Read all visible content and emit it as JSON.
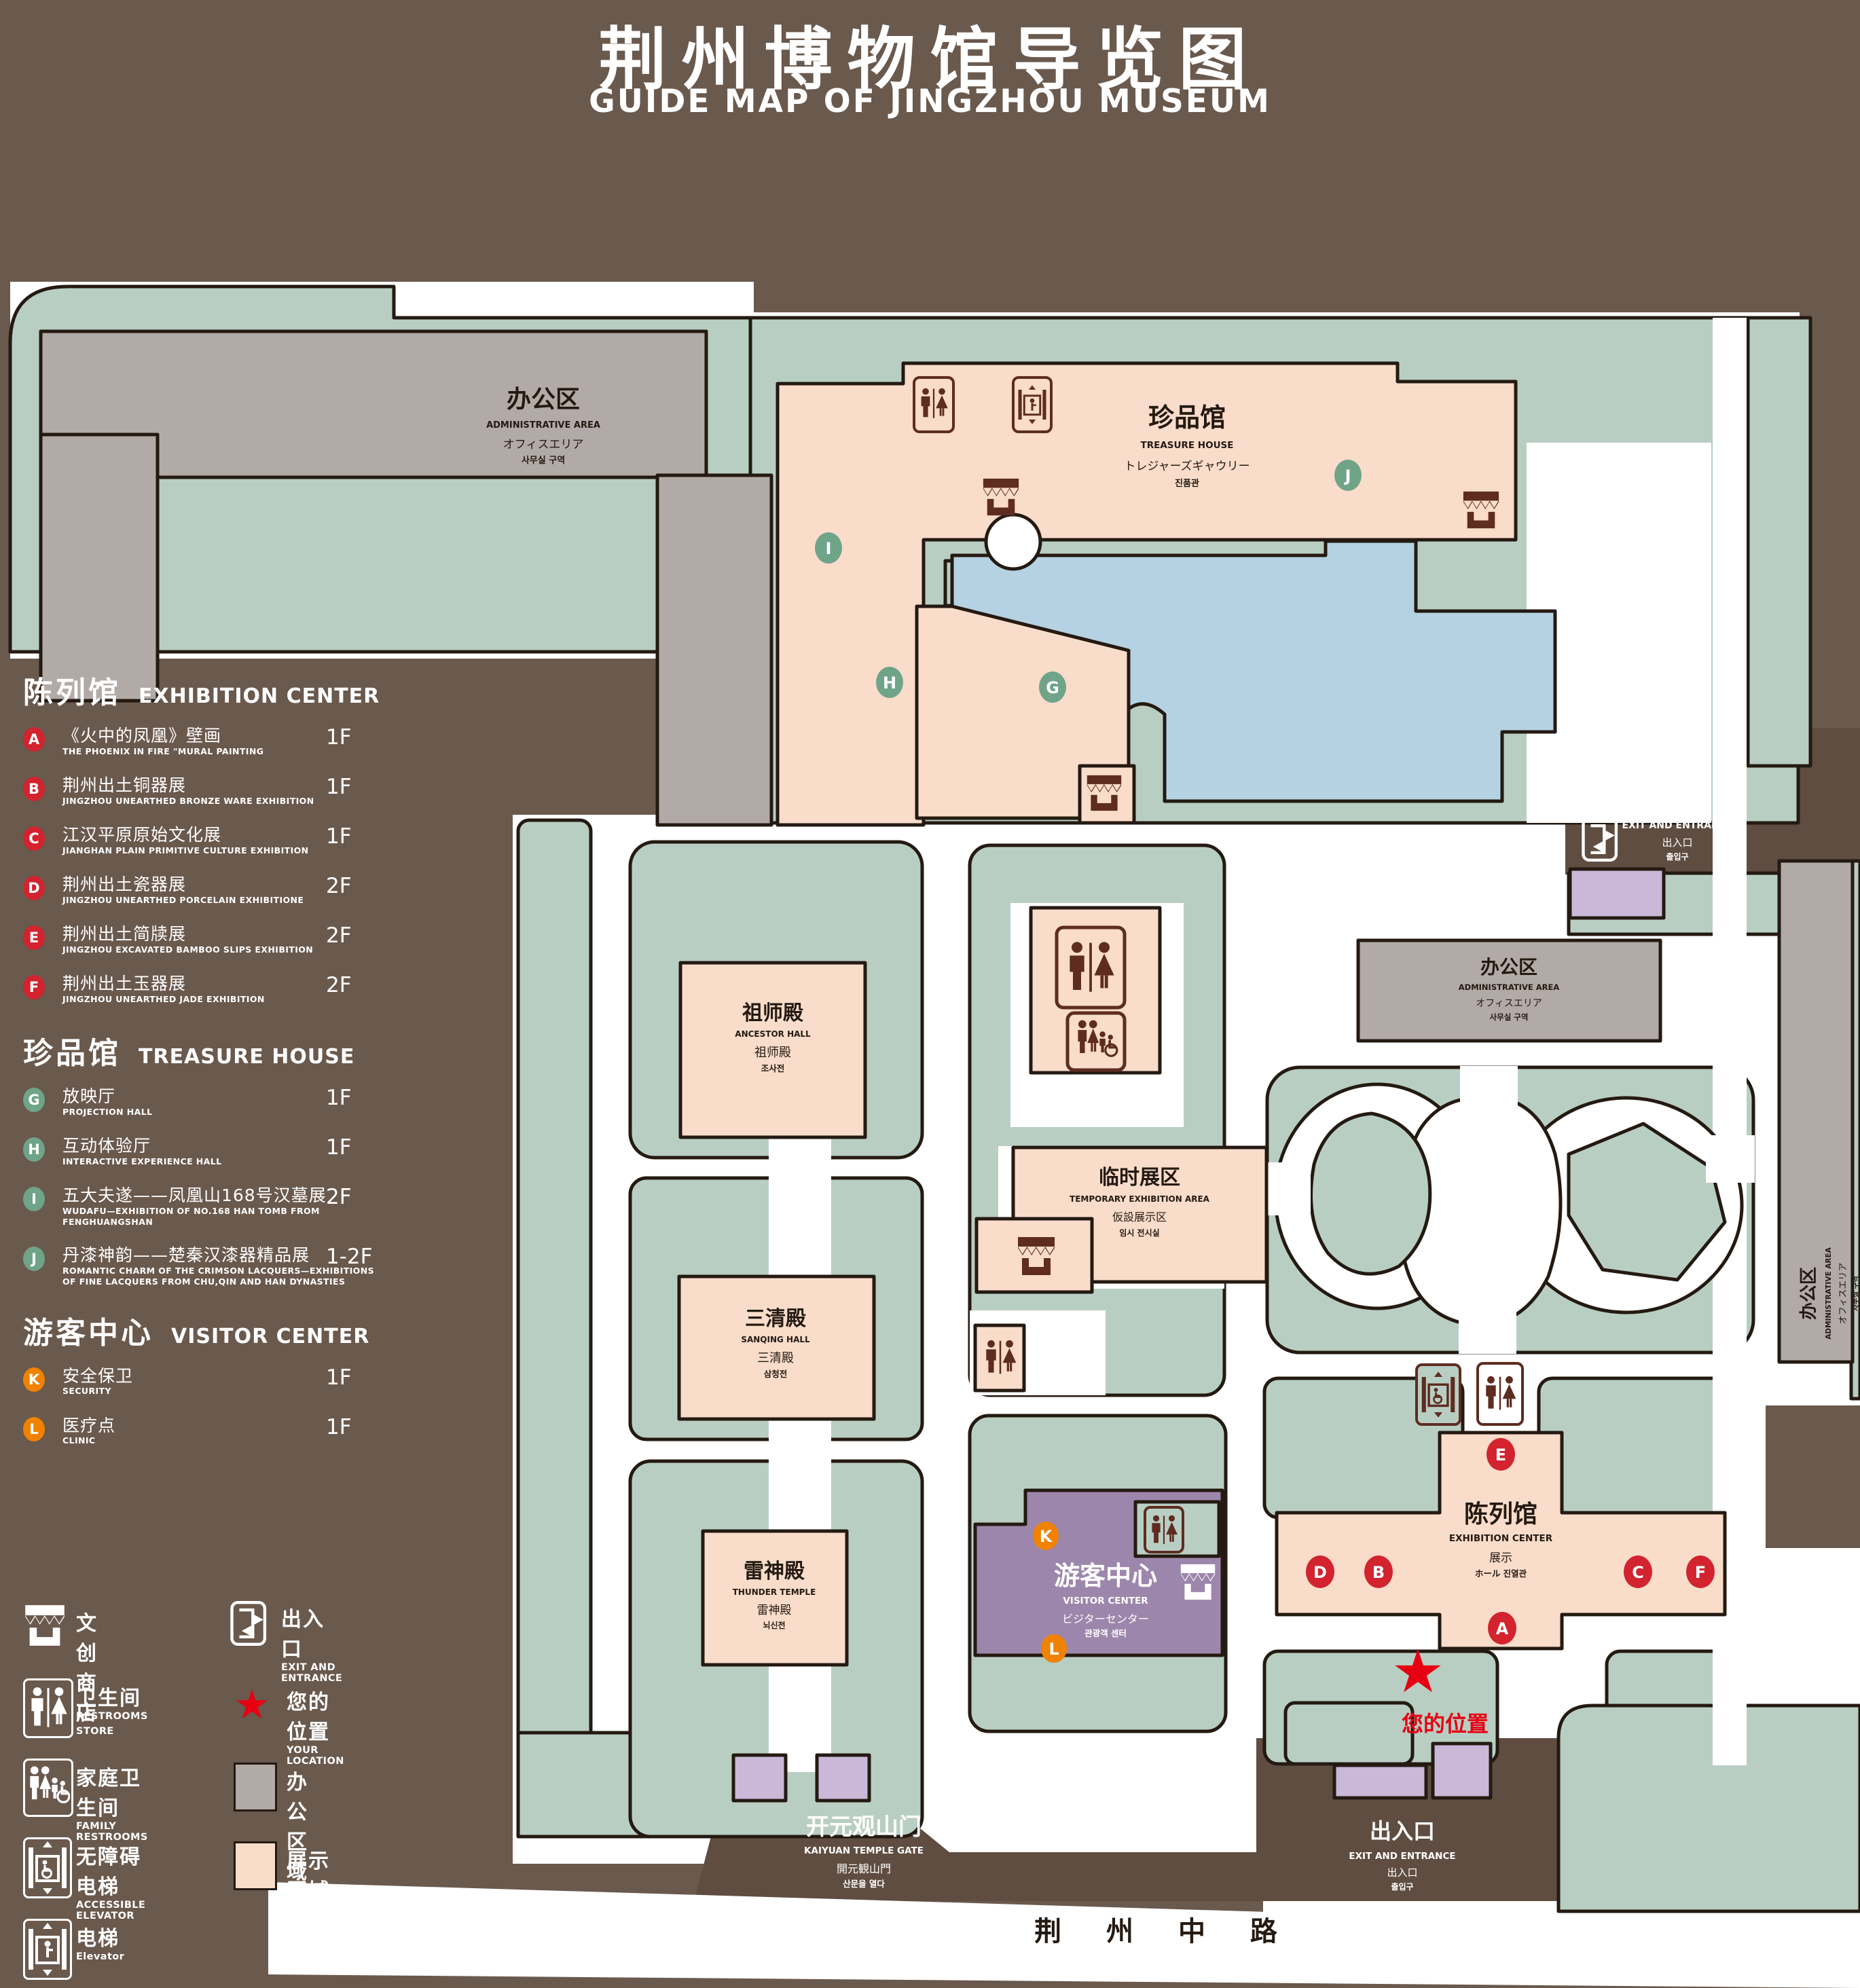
{
  "title": {
    "zh": "荆州博物馆导览图",
    "en": "GUIDE MAP OF JINGZHOU MUSEUM"
  },
  "colors": {
    "background": "#6a594d",
    "map_green": "#b9cec3",
    "display_area_pink": "#f9dcca",
    "office_area_gray": "#b2aaa6",
    "visitor_purple": "#9d86ab",
    "entrance_purple": "#c9b8d8",
    "pond_blue": "#b5d2e2",
    "outline": "#241a12",
    "badge_red": "#d2232f",
    "badge_green": "#6fa489",
    "badge_orange": "#f08200",
    "icon_maroon": "#5e2c21",
    "location_red": "#e60012"
  },
  "legend": {
    "sections": [
      {
        "zh": "陈列馆",
        "en": "EXHIBITION CENTER",
        "badge_color": "#d2232f",
        "items": [
          {
            "letter": "A",
            "zh": "《火中的凤凰》壁画",
            "en": "THE PHOENIX IN FIRE \"MURAL PAINTING",
            "floor": "1F"
          },
          {
            "letter": "B",
            "zh": "荆州出土铜器展",
            "en": "JINGZHOU UNEARTHED BRONZE WARE EXHIBITION",
            "floor": "1F"
          },
          {
            "letter": "C",
            "zh": "江汉平原原始文化展",
            "en": "JIANGHAN PLAIN PRIMITIVE CULTURE EXHIBITION",
            "floor": "1F"
          },
          {
            "letter": "D",
            "zh": "荆州出土瓷器展",
            "en": "JINGZHOU UNEARTHED PORCELAIN EXHIBITIONE",
            "floor": "2F"
          },
          {
            "letter": "E",
            "zh": "荆州出土简牍展",
            "en": "JINGZHOU EXCAVATED BAMBOO SLIPS EXHIBITION",
            "floor": "2F"
          },
          {
            "letter": "F",
            "zh": "荆州出土玉器展",
            "en": "JINGZHOU UNEARTHED JADE EXHIBITION",
            "floor": "2F"
          }
        ]
      },
      {
        "zh": "珍品馆",
        "en": "TREASURE HOUSE",
        "badge_color": "#6fa489",
        "items": [
          {
            "letter": "G",
            "zh": "放映厅",
            "en": "PROJECTION HALL",
            "floor": "1F"
          },
          {
            "letter": "H",
            "zh": "互动体验厅",
            "en": "INTERACTIVE EXPERIENCE HALL",
            "floor": "1F"
          },
          {
            "letter": "I",
            "zh": "五大夫遂——凤凰山168号汉墓展",
            "en": "WUDAFU—EXHIBITION OF NO.168 HAN TOMB FROM FENGHUANGSHAN",
            "floor": "2F"
          },
          {
            "letter": "J",
            "zh": "丹漆神韵——楚秦汉漆器精品展",
            "en": "ROMANTIC CHARM OF THE CRIMSON LACQUERS—EXHIBITIONS OF FINE LACQUERS FROM CHU,QIN AND HAN DYNASTIES",
            "floor": "1-2F"
          }
        ]
      },
      {
        "zh": "游客中心",
        "en": "VISITOR CENTER",
        "badge_color": "#f08200",
        "items": [
          {
            "letter": "K",
            "zh": "安全保卫",
            "en": "SECURITY",
            "floor": "1F"
          },
          {
            "letter": "L",
            "zh": "医疗点",
            "en": "CLINIC",
            "floor": "1F"
          }
        ]
      }
    ],
    "symbols": [
      {
        "icon": "store-icon",
        "zh": "文创商店",
        "en": "STORE"
      },
      {
        "icon": "exit-icon",
        "zh": "出入口",
        "en": "EXIT AND ENTRANCE"
      },
      {
        "icon": "restrooms-icon",
        "zh": "卫生间",
        "en": "RESTROOMS"
      },
      {
        "icon": "location-star-icon",
        "zh": "您的位置",
        "en": "YOUR LOCATION"
      },
      {
        "icon": "family-restrooms-icon",
        "zh": "家庭卫生间",
        "en": "FAMILY RESTROOMS"
      },
      {
        "icon": "office-area-swatch",
        "zh": "办公区域",
        "en": "OFFICE AREA"
      },
      {
        "icon": "accessible-elevator-icon",
        "zh": "无障碍电梯",
        "en": "ACCESSIBLE ELEVATOR"
      },
      {
        "icon": "display-area-swatch",
        "zh": "展示区域",
        "en": "DISPLAY AREA"
      },
      {
        "icon": "elevator-icon",
        "zh": "电梯",
        "en": "Elevator"
      }
    ]
  },
  "map": {
    "buildings": {
      "admin": {
        "zh": "办公区",
        "en": "ADMINISTRATIVE AREA",
        "jp": "オフィスエリア",
        "kr": "사무실 구역"
      },
      "treasure": {
        "zh": "珍品馆",
        "en": "TREASURE HOUSE",
        "jp": "トレジャーズギャウリー",
        "kr": "진품관"
      },
      "ancestor": {
        "zh": "祖师殿",
        "en": "ANCESTOR HALL",
        "zh2": "祖师殿",
        "kr": "조사전"
      },
      "temporary": {
        "zh": "临时展区",
        "en": "TEMPORARY EXHIBITION AREA",
        "jp": "仮設展示区",
        "kr": "임시 전시실"
      },
      "sanqing": {
        "zh": "三清殿",
        "en": "SANQING HALL",
        "zh2": "三清殿",
        "kr": "삼청전"
      },
      "thunder": {
        "zh": "雷神殿",
        "en": "THUNDER TEMPLE",
        "zh2": "雷神殿",
        "kr": "뇌신전"
      },
      "visitor": {
        "zh": "游客中心",
        "en": "VISITOR CENTER",
        "jp": "ビジターセンター",
        "kr": "관광객 센터"
      },
      "exhibition": {
        "zh": "陈列馆",
        "en": "EXHIBITION CENTER",
        "zh2": "展示",
        "jpkr": "ホール 진열관"
      },
      "gate": {
        "zh": "开元观山门",
        "en": "KAIYUAN TEMPLE GATE",
        "jp": "開元観山門",
        "kr": "산문을 열다"
      }
    },
    "exit": {
      "zh": "出入口",
      "en": "EXIT AND ENTRANCE",
      "zh2": "出入口",
      "kr": "출입구"
    },
    "road": "荆 州 中 路",
    "your_location": "您的位置",
    "markers": {
      "A": "A",
      "B": "B",
      "C": "C",
      "D": "D",
      "E": "E",
      "F": "F",
      "G": "G",
      "H": "H",
      "I": "I",
      "J": "J",
      "K": "K",
      "L": "L"
    }
  }
}
